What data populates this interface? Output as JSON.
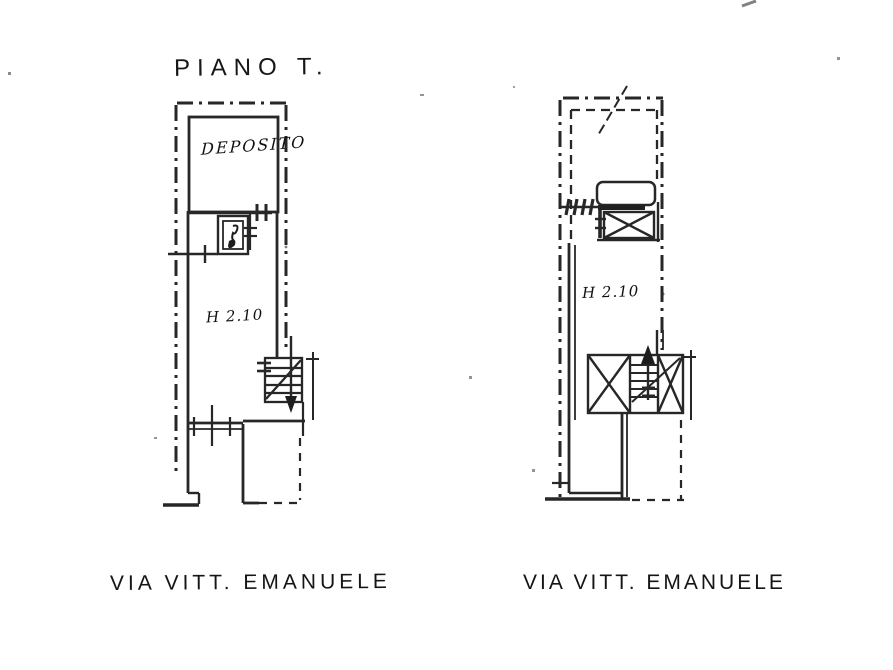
{
  "document": {
    "title": "PIANO T.",
    "plans": {
      "left": {
        "room_label": "DEPOSITO",
        "height_label": "H 2.10",
        "street_label": "VIA VITT. EMANUELE"
      },
      "right": {
        "height_label": "H 2.10",
        "street_label": "VIA VITT. EMANUELE"
      }
    },
    "colors": {
      "ink": "#1a1a1a",
      "paper": "#ffffff"
    }
  }
}
